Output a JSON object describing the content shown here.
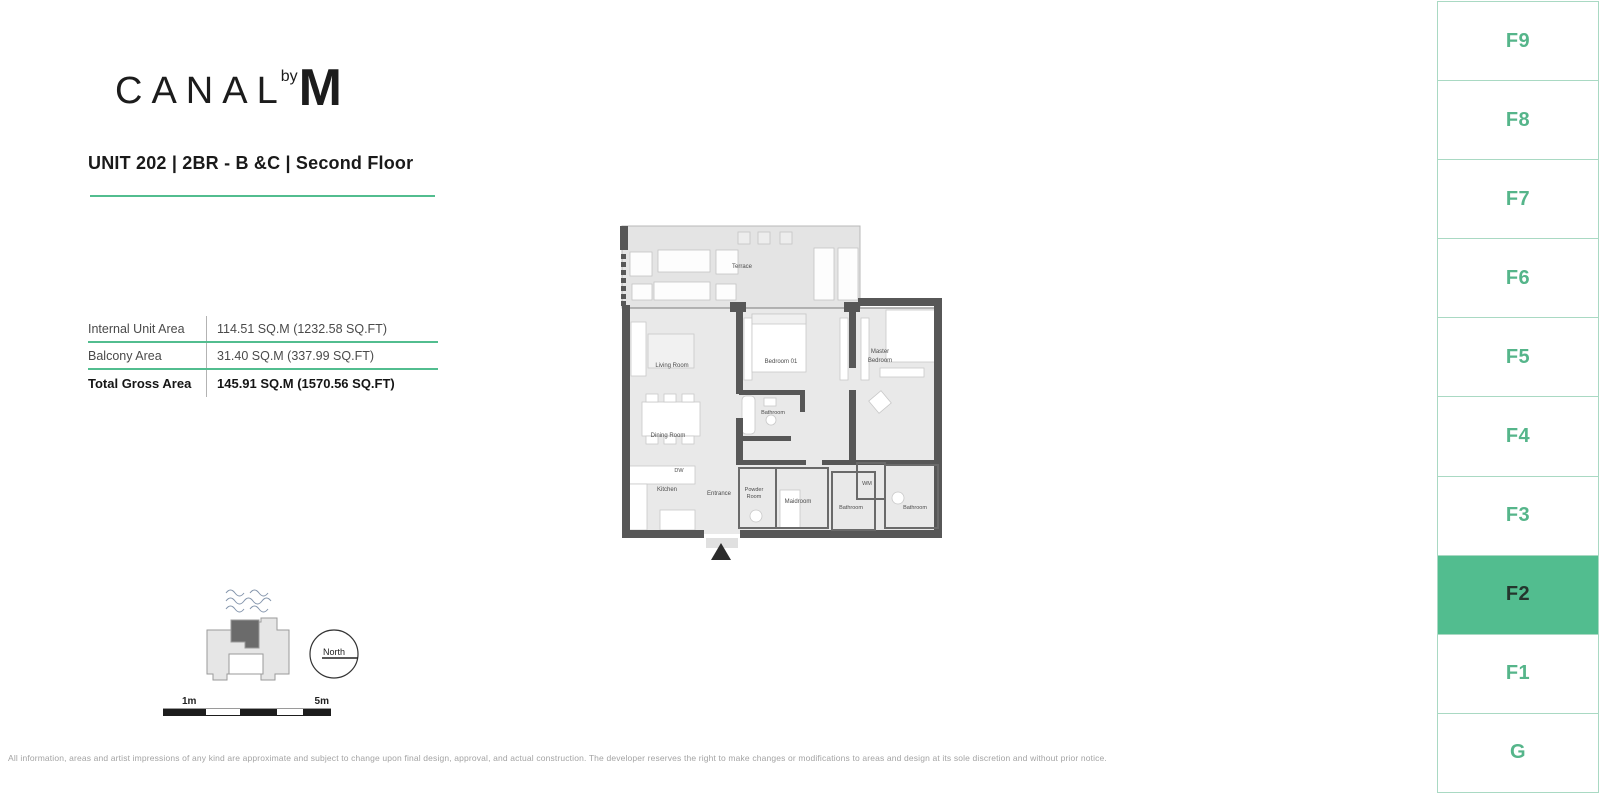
{
  "brand": {
    "canal": "CANAL",
    "by": "by",
    "m": "M"
  },
  "header": {
    "title": "UNIT 202 | 2BR - B &C | Second Floor"
  },
  "area_table": {
    "rows": [
      {
        "label": "Internal Unit Area",
        "value": "114.51 SQ.M (1232.58 SQ.FT)"
      },
      {
        "label": "Balcony Area",
        "value": "31.40 SQ.M (337.99 SQ.FT)"
      },
      {
        "label": "Total Gross Area",
        "value": "145.91 SQ.M (1570.56 SQ.FT)"
      }
    ]
  },
  "plan": {
    "rooms": {
      "terrace": "Terrace",
      "living_room": "Living Room",
      "bedroom_01": "Bedroom 01",
      "master_line1": "Master",
      "master_line2": "Bedroom",
      "bathroom_01": "Bathroom",
      "dining_room": "Dining Room",
      "kitchen": "Kitchen",
      "dw": "DW",
      "entrance": "Entrance",
      "powder_line1": "Powder",
      "powder_line2": "Room",
      "maidroom": "Maidroom",
      "bathroom_02": "Bathroom",
      "wm": "WM",
      "bathroom_03": "Bathroom"
    }
  },
  "locator": {
    "north_label": "North",
    "scale_start": "1m",
    "scale_end": "5m"
  },
  "floor_selector": {
    "floors": [
      "F9",
      "F8",
      "F7",
      "F6",
      "F5",
      "F4",
      "F3",
      "F2",
      "F1",
      "G"
    ],
    "selected": "F2"
  },
  "footer": {
    "disclaimer": "All information, areas and artist impressions of any kind are approximate and subject to change upon final design, approval, and actual construction. The developer reserves the right to make changes or modifications to areas and design at its sole discretion and without prior notice."
  },
  "colors": {
    "accent": "#52bd8f",
    "sidebar_border": "#a9d9c3",
    "wall": "#575757",
    "floor": "#e9e9e9",
    "selected_text": "#24352d"
  }
}
